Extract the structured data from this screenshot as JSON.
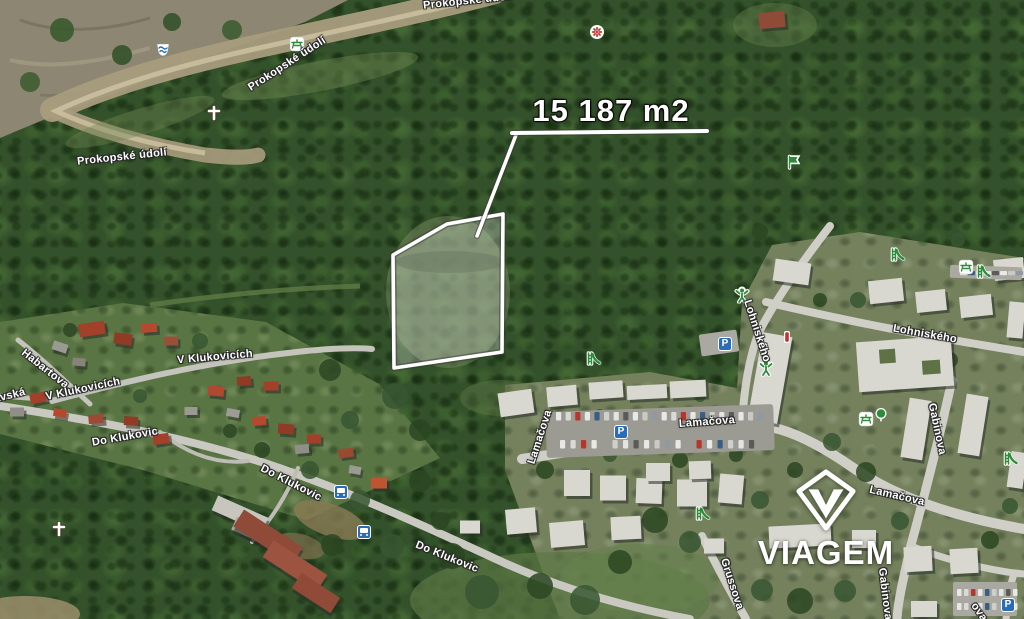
{
  "annotation": {
    "area_text": "15 187 m2"
  },
  "logo": {
    "text": "VIAGEM"
  },
  "map": {
    "labels": [
      {
        "text": "Prokopské údolí",
        "x": 122,
        "y": 157,
        "rot": -6
      },
      {
        "text": "Prokopské údolí",
        "x": 287,
        "y": 64,
        "rot": -33
      },
      {
        "text": "Prokopské údolí",
        "x": 468,
        "y": 1,
        "rot": -6
      },
      {
        "text": "Habartova",
        "x": 45,
        "y": 369,
        "rot": 38
      },
      {
        "text": "V Klukovicích",
        "x": 215,
        "y": 357,
        "rot": -5
      },
      {
        "text": "V Klukovicích",
        "x": 83,
        "y": 389,
        "rot": -12
      },
      {
        "text": "lavská",
        "x": 8,
        "y": 396,
        "rot": -14
      },
      {
        "text": "Do Klukovic",
        "x": 125,
        "y": 437,
        "rot": -10
      },
      {
        "text": "Do Klukovic",
        "x": 291,
        "y": 483,
        "rot": 27
      },
      {
        "text": "Do Klukovic",
        "x": 447,
        "y": 557,
        "rot": 22
      },
      {
        "text": "Lamačova",
        "x": 540,
        "y": 437,
        "rot": -72
      },
      {
        "text": "Lamačova",
        "x": 707,
        "y": 422,
        "rot": -4
      },
      {
        "text": "Lohniského",
        "x": 757,
        "y": 331,
        "rot": 72
      },
      {
        "text": "Lohniského",
        "x": 925,
        "y": 334,
        "rot": 10
      },
      {
        "text": "Gabinova",
        "x": 937,
        "y": 429,
        "rot": 78
      },
      {
        "text": "Lamačova",
        "x": 897,
        "y": 496,
        "rot": 13
      },
      {
        "text": "Grussova",
        "x": 732,
        "y": 584,
        "rot": 72
      },
      {
        "text": "Gabinova",
        "x": 885,
        "y": 594,
        "rot": 83
      },
      {
        "text": "ova",
        "x": 979,
        "y": 612,
        "rot": 55
      }
    ],
    "icons": [
      {
        "type": "spring",
        "x": 163,
        "y": 50
      },
      {
        "type": "cross",
        "x": 214,
        "y": 113
      },
      {
        "type": "picnic",
        "x": 297,
        "y": 44
      },
      {
        "type": "flower",
        "x": 597,
        "y": 32
      },
      {
        "type": "flag",
        "x": 793,
        "y": 162
      },
      {
        "type": "playground",
        "x": 742,
        "y": 295
      },
      {
        "type": "parking",
        "x": 725,
        "y": 344
      },
      {
        "type": "memorial",
        "x": 787,
        "y": 337
      },
      {
        "type": "playground",
        "x": 766,
        "y": 368
      },
      {
        "type": "slide",
        "x": 593,
        "y": 359
      },
      {
        "type": "parking",
        "x": 621,
        "y": 432
      },
      {
        "type": "slide",
        "x": 897,
        "y": 255
      },
      {
        "type": "picnic",
        "x": 966,
        "y": 267
      },
      {
        "type": "slide",
        "x": 983,
        "y": 272
      },
      {
        "type": "picnic",
        "x": 866,
        "y": 419
      },
      {
        "type": "tree",
        "x": 881,
        "y": 415
      },
      {
        "type": "slide",
        "x": 1010,
        "y": 459
      },
      {
        "type": "slide",
        "x": 702,
        "y": 514
      },
      {
        "type": "cross",
        "x": 59,
        "y": 529
      },
      {
        "type": "bus",
        "x": 341,
        "y": 492
      },
      {
        "type": "bus",
        "x": 364,
        "y": 532
      },
      {
        "type": "parking",
        "x": 1008,
        "y": 605
      }
    ]
  },
  "parcel": {
    "points": [
      [
        393,
        255
      ],
      [
        447,
        224
      ],
      [
        503,
        214
      ],
      [
        502,
        352
      ],
      [
        394,
        368
      ]
    ],
    "leader": [
      [
        516,
        135
      ],
      [
        477,
        236
      ]
    ],
    "underline": [
      [
        512,
        133
      ],
      [
        707,
        131
      ]
    ]
  },
  "colors": {
    "parcel_outline": "#ffffff",
    "parking_blue": "#2b6cb8",
    "poi_green": "#2e8b3a",
    "poi_red": "#c2332b",
    "water_blue": "#1f6fb5",
    "label_text": "#ffffff"
  }
}
